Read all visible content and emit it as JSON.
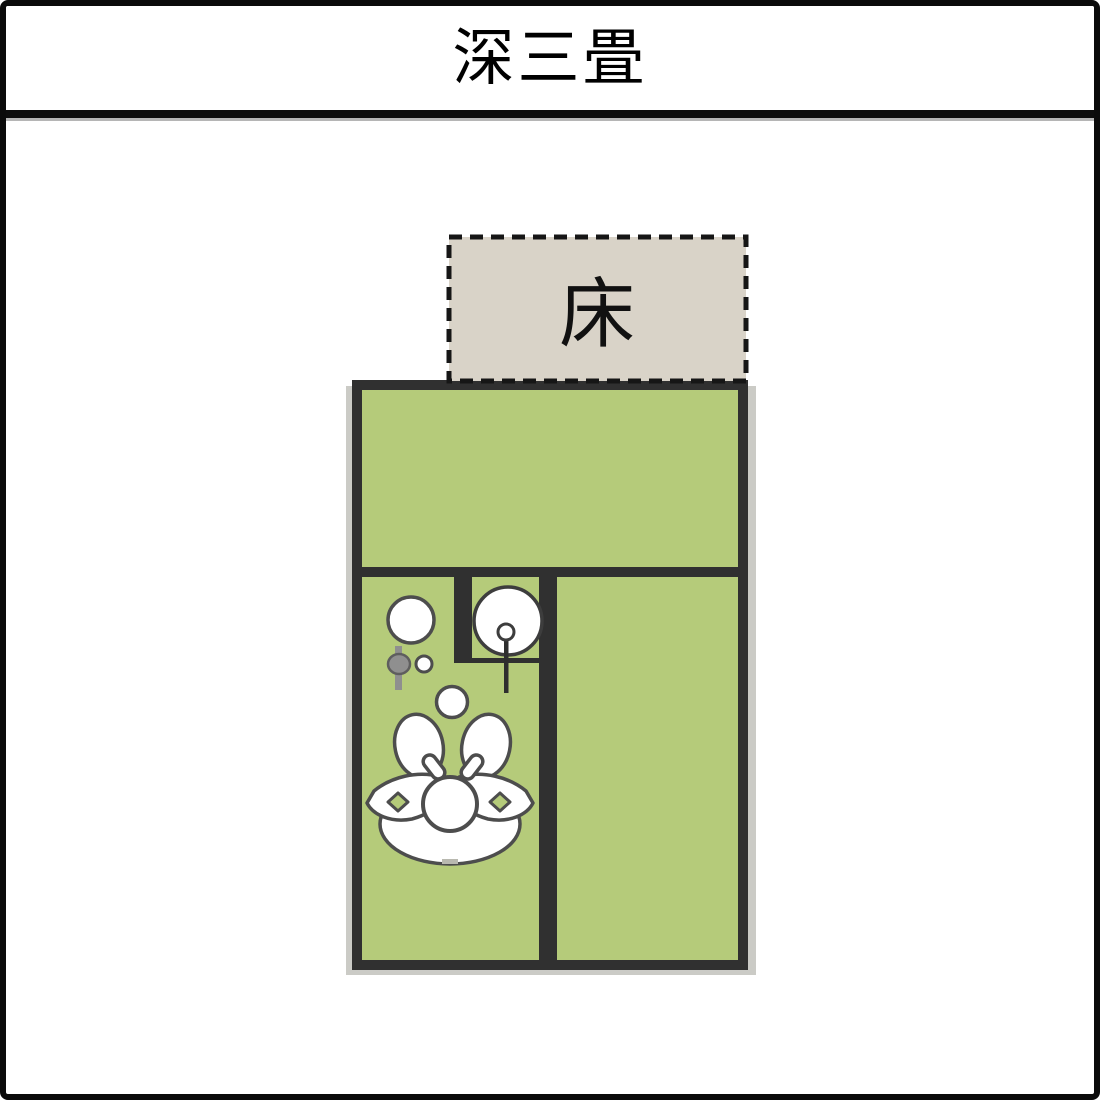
{
  "title": "深三畳",
  "floor_plan": {
    "toko": {
      "label": "床"
    },
    "colors": {
      "tatami_green": "#b5cb7a",
      "wall_dark": "#303030",
      "toko_beige": "#d9d3c8",
      "figure_outline": "#4d4d4d",
      "ladle_gray": "#8f8f8f",
      "shadow_gray": "#cbcbc6",
      "frame_black": "#0b0b0b",
      "background_white": "#ffffff"
    }
  }
}
